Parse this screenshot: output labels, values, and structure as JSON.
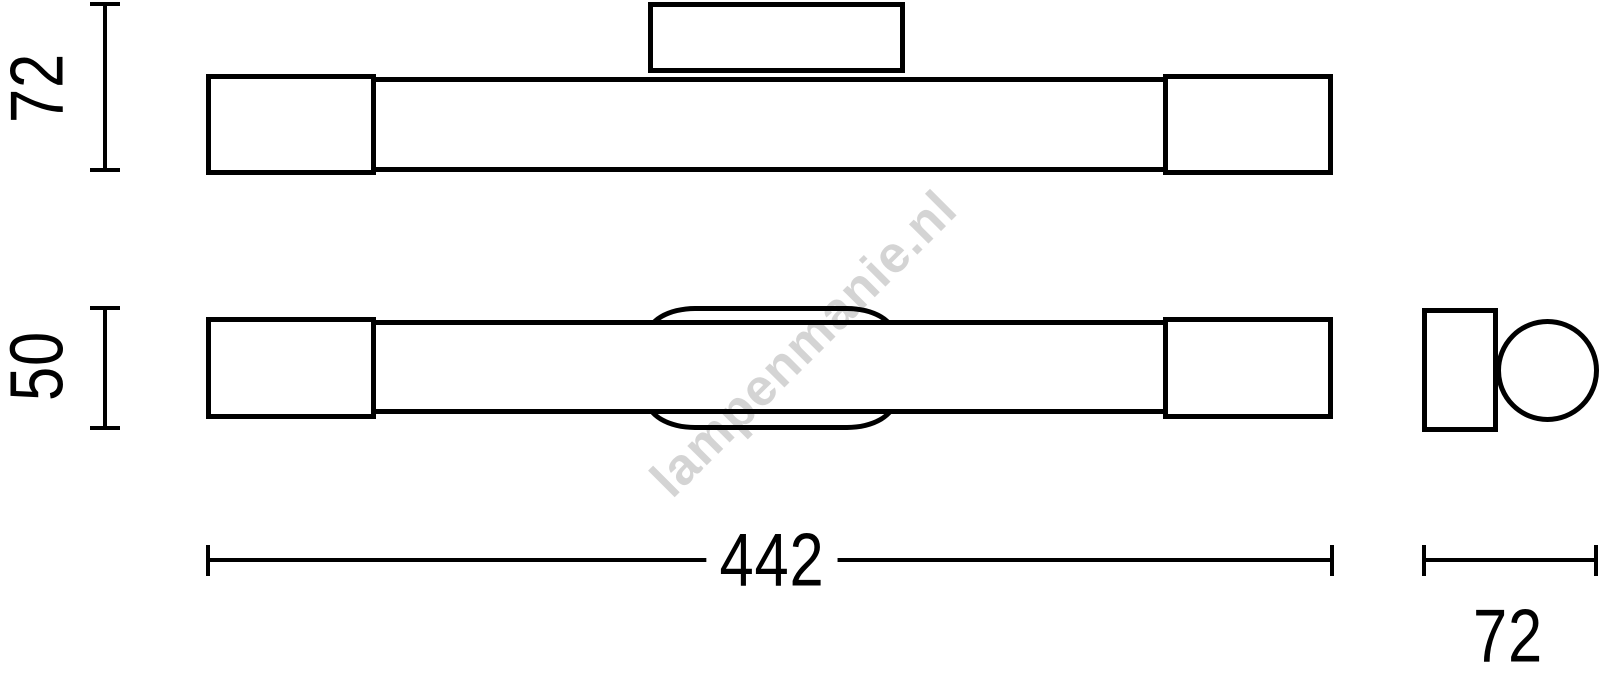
{
  "drawing": {
    "stroke_color": "#000000",
    "background_color": "#ffffff",
    "watermark_color": "#d6d6d6"
  },
  "watermark": {
    "text": "lampenmanie.nl"
  },
  "dimensions": {
    "total_height": {
      "value": "72"
    },
    "body_height": {
      "value": "50"
    },
    "total_width": {
      "value": "442"
    },
    "depth": {
      "value": "72"
    }
  }
}
